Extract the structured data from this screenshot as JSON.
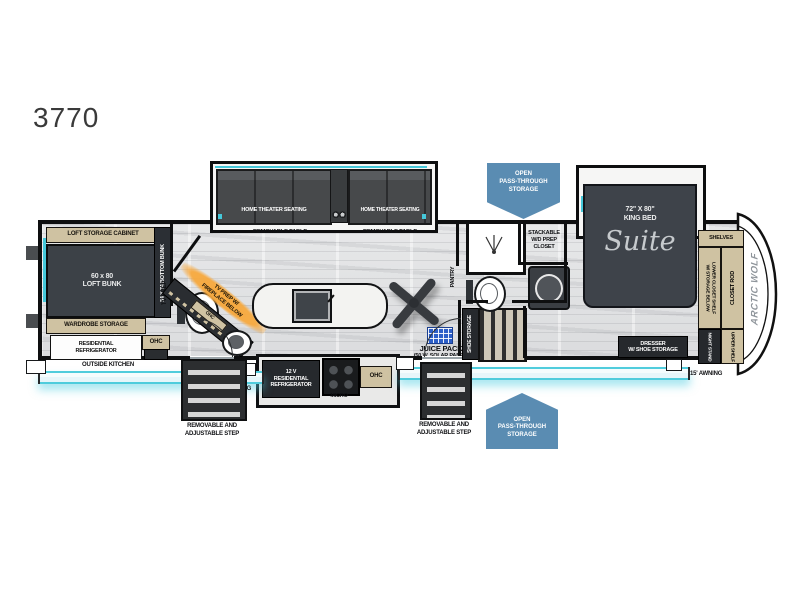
{
  "model": "3770",
  "branding": {
    "front_cap": "ARCTIC WOLF",
    "suite_script": "Suite"
  },
  "badges": {
    "pass_through": "OPEN\nPASS-THROUGH\nSTORAGE"
  },
  "bunk_room": {
    "loft_storage_cabinet": "LOFT STORAGE CABINET",
    "loft_bunk": "60 x 80\nLOFT BUNK",
    "bottom_bunk": "54 X 74 BOTTOM BUNK",
    "wardrobe_storage": "WARDROBE STORAGE",
    "residential_refrigerator": "RESIDENTIAL\nREFRIGERATOR",
    "ohc": "OHC",
    "outside_kitchen": "OUTSIDE KITCHEN",
    "tv_prep": "TV PREP"
  },
  "living": {
    "home_theater_seating": "HOME THEATER SEATING",
    "removable_table": "REMOVABLE TABLE",
    "tv_prep_fireplace": "TV PREP W/\nFIREPLACE BELOW",
    "ohc_fireplace": "OHC",
    "juice_pack": "JUICE PACK",
    "juice_pack_sub": "(50 W. SOLAR PANEL)"
  },
  "kitchen": {
    "fridge_12v": "12 V\nRESIDENTIAL\nREFRIGERATOR",
    "micro": "MICRO",
    "ohc": "OHC",
    "pantry": "PANTRY"
  },
  "bath": {
    "stackable_wd": "STACKABLE\nW/D PREP\nCLOSET",
    "shoe_storage": "SHOE STORAGE"
  },
  "bedroom": {
    "king_bed": "72\" X 80\"\nKING BED",
    "dresser": "DRESSER\nW/ SHOE STORAGE",
    "shelves": "SHELVES",
    "closet_rod": "CLOSET ROD",
    "lower_closet_shelf": "LOWER CLOSET SHELF\nW/ STORAGE BELOW",
    "upper_shelf": "UPPER SHELF",
    "night_stand": "NIGHT STAND"
  },
  "exterior": {
    "awning_left": "12' AWNING",
    "awning_right": "15' AWNING",
    "step_label": "REMOVABLE AND\nADJUSTABLE STEP"
  },
  "colors": {
    "accent_teal": "#45c8da",
    "badge_blue": "#5a8cb2",
    "highlight_orange": "#f5a63c",
    "solar_blue": "#2d5fc8",
    "label_tan": "#cfc2a2"
  }
}
